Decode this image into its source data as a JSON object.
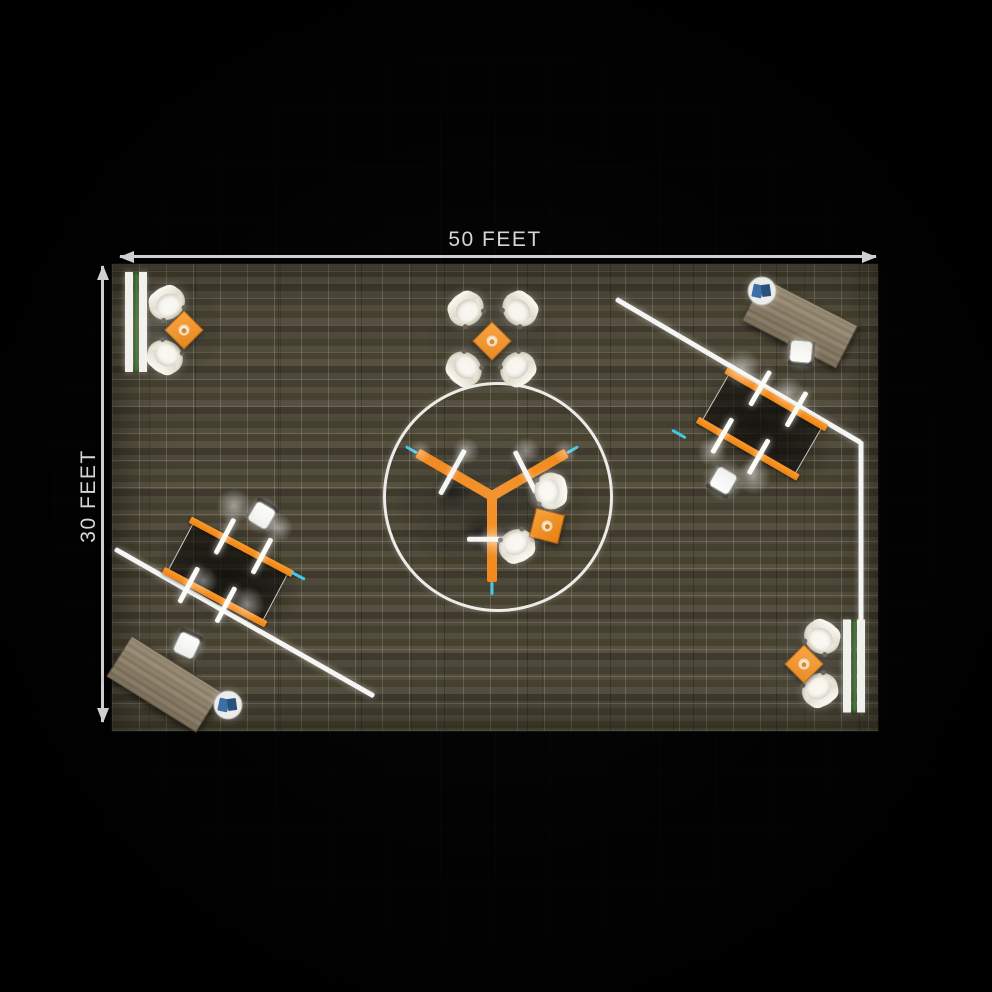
{
  "dimensions": {
    "width_label": "50 FEET",
    "height_label": "30 FEET"
  },
  "colors": {
    "background": "#000000",
    "dimension_line": "#cfcfcf",
    "dimension_text": "#d6d6d6",
    "floor_base": "#4e4939",
    "floor_grid": "#d8d8c8",
    "accent_orange": "#f28a1e",
    "wall_white": "#f5f5f3",
    "bench_green": "#3f7a2f",
    "cyan_accent": "#45c7e9",
    "desk_wood": "#8c7f67",
    "chair_cream": "#ece7d9"
  },
  "floor": {
    "x": 112,
    "y": 264,
    "w": 766,
    "h": 467,
    "grid_spacing": 27
  },
  "items": [
    {
      "t": "shadow",
      "name": "table-shadow",
      "x": 762,
      "y": 430,
      "w": 160,
      "h": 100,
      "rot": 30,
      "o": 0.5
    },
    {
      "t": "shadow",
      "name": "table-shadow",
      "x": 228,
      "y": 576,
      "w": 160,
      "h": 100,
      "rot": 28,
      "o": 0.5
    },
    {
      "t": "shadow",
      "name": "hub-shadow",
      "x": 492,
      "y": 505,
      "w": 200,
      "h": 155,
      "rot": 0,
      "o": 0.45
    },
    {
      "t": "shadow",
      "name": "desk-shadow",
      "x": 800,
      "y": 330,
      "w": 120,
      "h": 62,
      "rot": 27,
      "o": 0.4
    },
    {
      "t": "shadow",
      "name": "desk-shadow",
      "x": 166,
      "y": 688,
      "w": 120,
      "h": 62,
      "rot": 32,
      "o": 0.4
    },
    {
      "t": "shadow",
      "name": "lounge-shadow",
      "x": 176,
      "y": 330,
      "w": 100,
      "h": 100,
      "rot": 0,
      "o": 0.3
    },
    {
      "t": "shadow",
      "name": "lounge-shadow",
      "x": 492,
      "y": 340,
      "w": 135,
      "h": 115,
      "rot": 0,
      "o": 0.3
    },
    {
      "t": "shadow",
      "name": "lounge-shadow",
      "x": 812,
      "y": 664,
      "w": 100,
      "h": 100,
      "rot": 0,
      "o": 0.3
    },
    {
      "t": "shadow",
      "name": "chair-shadow",
      "x": 452,
      "y": 490,
      "w": 44,
      "h": 38,
      "rot": -20,
      "o": 0.5
    },
    {
      "t": "shadow",
      "name": "chair-shadow",
      "x": 481,
      "y": 533,
      "w": 44,
      "h": 38,
      "rot": 15,
      "o": 0.5
    },
    {
      "t": "shadow",
      "name": "chair-shadow",
      "x": 527,
      "y": 472,
      "w": 40,
      "h": 34,
      "rot": 0,
      "o": 0.42
    },
    {
      "t": "circle",
      "name": "hub-circle-outline",
      "x": 495,
      "y": 494,
      "r": 112
    },
    {
      "t": "bar",
      "name": "wall",
      "x": 616,
      "y": 299,
      "len": 284,
      "rot": 30.4,
      "th": 5,
      "c": "wall"
    },
    {
      "t": "bar",
      "name": "wall",
      "x": 861,
      "y": 441,
      "len": 181,
      "rot": 90,
      "th": 5,
      "c": "wall"
    },
    {
      "t": "bar",
      "name": "wall",
      "x": 115,
      "y": 549,
      "len": 298,
      "rot": 29.6,
      "th": 5,
      "c": "wall"
    },
    {
      "t": "bar",
      "name": "hub-arm",
      "x": 492,
      "y": 496,
      "len": 86,
      "rot": 210,
      "th": 10,
      "c": "orange"
    },
    {
      "t": "bar",
      "name": "hub-arm",
      "x": 492,
      "y": 496,
      "len": 86,
      "rot": -30,
      "th": 10,
      "c": "orange"
    },
    {
      "t": "bar",
      "name": "hub-arm",
      "x": 492,
      "y": 496,
      "len": 86,
      "rot": 90,
      "th": 10,
      "c": "orange"
    },
    {
      "t": "bar",
      "name": "hub-desk",
      "x": 465,
      "y": 450,
      "len": 51,
      "rot": 119,
      "th": 4.5,
      "c": "white"
    },
    {
      "t": "bar",
      "name": "hub-desk",
      "x": 515,
      "y": 451,
      "len": 47,
      "rot": 63,
      "th": 4.5,
      "c": "white"
    },
    {
      "t": "bar",
      "name": "hub-desk",
      "x": 467,
      "y": 539,
      "len": 53,
      "rot": 0,
      "th": 4.5,
      "c": "white"
    },
    {
      "t": "ws",
      "name": "workstation-table",
      "x": 762,
      "y": 424,
      "len": 112,
      "wid": 58,
      "rot": 30
    },
    {
      "t": "ws",
      "name": "workstation-table",
      "x": 228,
      "y": 572,
      "len": 112,
      "wid": 58,
      "rot": 28
    },
    {
      "t": "desk",
      "name": "desk",
      "x": 800,
      "y": 323,
      "w": 104,
      "h": 46,
      "rot": 27
    },
    {
      "t": "desk",
      "name": "desk",
      "x": 164,
      "y": 684,
      "w": 104,
      "h": 46,
      "rot": 32
    },
    {
      "t": "bench",
      "name": "bench-planter",
      "x": 136,
      "y": 322,
      "w": 22,
      "h": 100
    },
    {
      "t": "bench",
      "name": "bench-planter",
      "x": 854,
      "y": 666,
      "w": 22,
      "h": 93
    },
    {
      "t": "stable",
      "name": "side-table",
      "x": 762,
      "y": 291
    },
    {
      "t": "stable",
      "name": "side-table",
      "x": 228,
      "y": 705
    },
    {
      "t": "ochair",
      "name": "office-chair",
      "x": 801,
      "y": 352,
      "rot": 185
    },
    {
      "t": "ochair",
      "name": "office-chair",
      "x": 187,
      "y": 645,
      "rot": 25
    },
    {
      "t": "ochair",
      "name": "office-chair",
      "x": 723,
      "y": 481,
      "rot": 210
    },
    {
      "t": "ochair",
      "name": "office-chair",
      "x": 262,
      "y": 515,
      "rot": 31
    },
    {
      "t": "tub",
      "name": "lounge-chair",
      "x": 167,
      "y": 303,
      "rot": -32
    },
    {
      "t": "tub",
      "name": "lounge-chair",
      "x": 165,
      "y": 357,
      "rot": -145
    },
    {
      "t": "tub",
      "name": "lounge-chair",
      "x": 466,
      "y": 309,
      "rot": -41
    },
    {
      "t": "tub",
      "name": "lounge-chair",
      "x": 520,
      "y": 309,
      "rot": 43
    },
    {
      "t": "tub",
      "name": "lounge-chair",
      "x": 464,
      "y": 369,
      "rot": -137
    },
    {
      "t": "tub",
      "name": "lounge-chair",
      "x": 518,
      "y": 369,
      "rot": 139
    },
    {
      "t": "tub",
      "name": "lounge-chair",
      "x": 822,
      "y": 637,
      "rot": 34
    },
    {
      "t": "tub",
      "name": "lounge-chair",
      "x": 820,
      "y": 690,
      "rot": 148
    },
    {
      "t": "tub",
      "name": "lounge-chair",
      "x": 551,
      "y": 491,
      "rot": 85
    },
    {
      "t": "tub",
      "name": "lounge-chair",
      "x": 517,
      "y": 546,
      "rot": 153
    },
    {
      "t": "diamond",
      "name": "coffee-table",
      "x": 184,
      "y": 330,
      "s": 26,
      "rot": 45
    },
    {
      "t": "diamond",
      "name": "coffee-table",
      "x": 492,
      "y": 341,
      "s": 26,
      "rot": 45
    },
    {
      "t": "diamond",
      "name": "coffee-table",
      "x": 804,
      "y": 664,
      "s": 26,
      "rot": 45
    },
    {
      "t": "diamond",
      "name": "coffee-table",
      "x": 547,
      "y": 526,
      "s": 28,
      "rot": 14
    },
    {
      "t": "bar",
      "name": "cyan-marker",
      "x": 417,
      "y": 453,
      "len": 13,
      "rot": 210,
      "th": 3,
      "c": "cyan"
    },
    {
      "t": "bar",
      "name": "cyan-marker",
      "x": 567,
      "y": 453,
      "len": 13,
      "rot": -30,
      "th": 3,
      "c": "cyan"
    },
    {
      "t": "bar",
      "name": "cyan-marker",
      "x": 492,
      "y": 582,
      "len": 13,
      "rot": 90,
      "th": 3,
      "c": "cyan"
    },
    {
      "t": "bar",
      "name": "cyan-marker",
      "x": 291,
      "y": 572,
      "len": 16,
      "rot": 28,
      "th": 3,
      "c": "cyan"
    },
    {
      "t": "bar",
      "name": "cyan-marker",
      "x": 672,
      "y": 430,
      "len": 16,
      "rot": 30,
      "th": 3,
      "c": "cyan"
    },
    {
      "t": "glow",
      "name": "light-glow",
      "x": 742,
      "y": 369,
      "r": 20,
      "o": 0.5
    },
    {
      "t": "glow",
      "name": "light-glow",
      "x": 788,
      "y": 393,
      "r": 17,
      "o": 0.45
    },
    {
      "t": "glow",
      "name": "light-glow",
      "x": 712,
      "y": 452,
      "r": 15,
      "o": 0.4
    },
    {
      "t": "glow",
      "name": "light-glow",
      "x": 753,
      "y": 477,
      "r": 18,
      "o": 0.45
    },
    {
      "t": "glow",
      "name": "light-glow",
      "x": 724,
      "y": 480,
      "r": 22,
      "o": 0.5
    },
    {
      "t": "glow",
      "name": "light-glow",
      "x": 234,
      "y": 506,
      "r": 18,
      "o": 0.5
    },
    {
      "t": "glow",
      "name": "light-glow",
      "x": 278,
      "y": 528,
      "r": 15,
      "o": 0.45
    },
    {
      "t": "glow",
      "name": "light-glow",
      "x": 203,
      "y": 581,
      "r": 15,
      "o": 0.4
    },
    {
      "t": "glow",
      "name": "light-glow",
      "x": 247,
      "y": 604,
      "r": 18,
      "o": 0.45
    },
    {
      "t": "glow",
      "name": "light-glow",
      "x": 262,
      "y": 515,
      "r": 20,
      "o": 0.5
    },
    {
      "t": "glow",
      "name": "light-glow",
      "x": 549,
      "y": 492,
      "r": 24,
      "o": 0.5
    },
    {
      "t": "glow",
      "name": "light-glow",
      "x": 519,
      "y": 546,
      "r": 20,
      "o": 0.45
    },
    {
      "t": "glow",
      "name": "light-glow",
      "x": 466,
      "y": 451,
      "r": 14,
      "o": 0.4
    },
    {
      "t": "glow",
      "name": "light-glow",
      "x": 526,
      "y": 451,
      "r": 14,
      "o": 0.4
    },
    {
      "t": "glow",
      "name": "light-glow",
      "x": 493,
      "y": 540,
      "r": 16,
      "o": 0.4
    },
    {
      "t": "glow",
      "name": "light-glow",
      "x": 420,
      "y": 452,
      "r": 12,
      "o": 0.35
    },
    {
      "t": "glow",
      "name": "light-glow",
      "x": 565,
      "y": 452,
      "r": 12,
      "o": 0.35
    },
    {
      "t": "glow",
      "name": "light-glow",
      "x": 801,
      "y": 352,
      "r": 20,
      "o": 0.45
    },
    {
      "t": "glow",
      "name": "light-glow",
      "x": 187,
      "y": 645,
      "r": 20,
      "o": 0.45
    },
    {
      "t": "glow",
      "name": "light-glow",
      "x": 168,
      "y": 305,
      "r": 16,
      "o": 0.4
    },
    {
      "t": "glow",
      "name": "light-glow",
      "x": 166,
      "y": 356,
      "r": 16,
      "o": 0.4
    },
    {
      "t": "glow",
      "name": "light-glow",
      "x": 822,
      "y": 638,
      "r": 16,
      "o": 0.4
    },
    {
      "t": "glow",
      "name": "light-glow",
      "x": 820,
      "y": 690,
      "r": 16,
      "o": 0.4
    },
    {
      "t": "glow",
      "name": "light-glow",
      "x": 467,
      "y": 310,
      "r": 14,
      "o": 0.35
    },
    {
      "t": "glow",
      "name": "light-glow",
      "x": 519,
      "y": 310,
      "r": 14,
      "o": 0.35
    },
    {
      "t": "glow",
      "name": "light-glow",
      "x": 465,
      "y": 368,
      "r": 14,
      "o": 0.35
    },
    {
      "t": "glow",
      "name": "light-glow",
      "x": 517,
      "y": 368,
      "r": 14,
      "o": 0.35
    },
    {
      "t": "glow",
      "name": "ambient-glow",
      "x": 160,
      "y": 330,
      "r": 55,
      "o": 0.12
    },
    {
      "t": "glow",
      "name": "ambient-glow",
      "x": 812,
      "y": 665,
      "r": 55,
      "o": 0.12
    },
    {
      "t": "glow",
      "name": "ambient-glow",
      "x": 492,
      "y": 340,
      "r": 60,
      "o": 0.1
    },
    {
      "t": "glow",
      "name": "ambient-glow",
      "x": 495,
      "y": 495,
      "r": 85,
      "o": 0.08
    }
  ]
}
